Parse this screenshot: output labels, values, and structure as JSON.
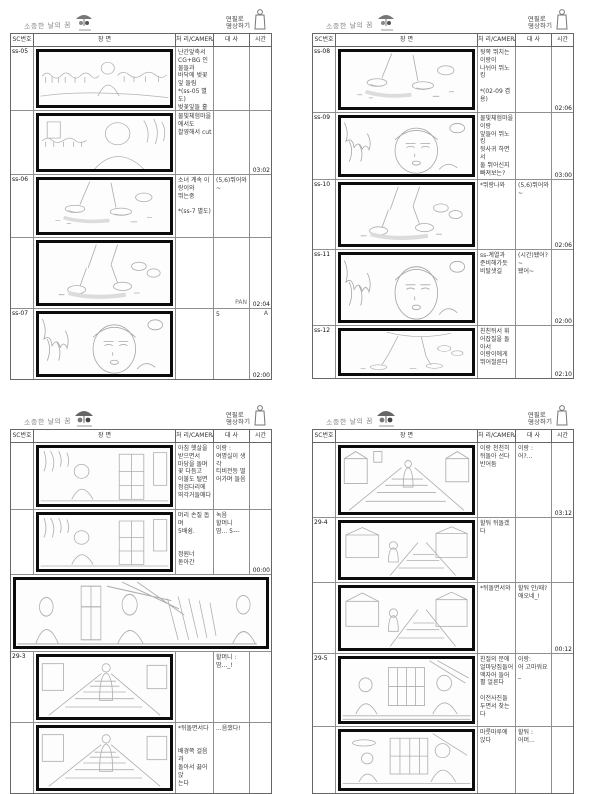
{
  "logo": {
    "left_title": "소중한 날의 꿈",
    "right_line1": "연필로",
    "right_line2": "명상하기"
  },
  "table_header": {
    "sc": "SC번호",
    "scene": "장  면",
    "camera": "처 리/CAMERA",
    "dialog": "대  사",
    "time": "시간"
  },
  "pages": [
    {
      "name": "page-1",
      "rows": [
        {
          "sc": "ss-05",
          "camera": "난간앞축서\nCG+BG 인물들과\n바닥에 벚꽃잎 들림\n*(ss-05 별도)\n벚꽃잎들 흩날려 쌓여있어 심게",
          "dialog": "",
          "time": "",
          "mark": ""
        },
        {
          "sc": "",
          "camera": "물빛체험마을에서도\n촬영해서 cut",
          "dialog": "",
          "time": "03:02",
          "mark": ""
        },
        {
          "sc": "ss-06",
          "camera": "소녀 계속 이랑이와\n뛰는중\n\n*(ss-7 별도)",
          "dialog": "(5,6)뛰어와~",
          "time": "",
          "mark": ""
        },
        {
          "sc": "",
          "camera": "",
          "dialog": "PAN",
          "time": "02:04",
          "mark": ""
        },
        {
          "sc": "ss-07",
          "camera": "",
          "dialog": "5",
          "time": "02:00",
          "mark": "A"
        }
      ]
    },
    {
      "name": "page-2",
      "rows": [
        {
          "sc": "ss-08",
          "camera": "뒷쪽 뛰치는 이랑이\n나뉘어 뛰노킹\n\n*(02-09 겸용)",
          "dialog": "",
          "time": "02:06",
          "mark": ""
        },
        {
          "sc": "ss-09",
          "camera": "물빛체험마을 이랑\n앞들어 뛰노킹\n뒷사귀 하면서\n둘 뛰어신지 빠져보는?\n\n*(ss-7A 겸용)",
          "dialog": "",
          "time": "03:00",
          "mark": ""
        },
        {
          "sc": "ss-10",
          "camera": "*뛰랑나와",
          "dialog": "(5,6)뛰어와~",
          "time": "02:06",
          "mark": ""
        },
        {
          "sc": "ss-11",
          "camera": "ss-계열과\n준비해가듯 비탈샛길",
          "dialog": "(시간)됐어?~\n됐어~",
          "time": "02:00",
          "mark": ""
        },
        {
          "sc": "ss-12",
          "camera": "친친뒤서 휘어잡질을 돌아서\n이랑이에게 뛰어절른다",
          "dialog": "",
          "time": "02:10",
          "mark": ""
        }
      ]
    },
    {
      "name": "page-3",
      "rows": [
        {
          "sc": "",
          "camera": "아침 햇살을\n받으면서\n마당을 돌며\n꽃 다듬고\n이불도 털면\n정검다리에\n뙤각거들매다",
          "dialog": "이랑 :\n여명실이 생각\n티비전등 떨어가며 들음",
          "time": "",
          "mark": ""
        },
        {
          "sc": "",
          "camera": "머리 손질 돕며\n5배쉼.\n\n\n정원너\n돋아간",
          "dialog": "녹음\n할머니\n땀... 5---",
          "time": "00:00",
          "mark": ""
        },
        {
          "wide": true
        },
        {
          "sc": "29-3",
          "camera": "",
          "dialog": "할머니 :\n땀..._!",
          "time": "",
          "mark": ""
        },
        {
          "sc": "",
          "camera": "*뒤돌면서다\n\n\n배경쪽 걸음과\n돌아서 끓어앉\n는다",
          "dialog": "...음쟀다!",
          "time": "",
          "mark": ""
        }
      ]
    },
    {
      "name": "page-4",
      "rows": [
        {
          "sc": "",
          "camera": "이랑 천천히\n뒤돌아 선다\n반어둠",
          "dialog": "이랑 :\n어?...",
          "time": "03:12",
          "mark": ""
        },
        {
          "sc": "29-4",
          "camera": "할둬 뒤돌겠다",
          "dialog": "",
          "time": "",
          "mark": ""
        },
        {
          "sc": "",
          "camera": "*뒤돌면서와",
          "dialog": "할둬 안/때?애오네_!",
          "time": "00:12",
          "mark": ""
        },
        {
          "sc": "29-5",
          "camera": "친절의 문에\n얼마당집들어\n액자어 들어\n펼 얼른다\n\n이전사진들\n두면서 찾는다",
          "dialog": "이랑:\n어 고마워요_",
          "time": "",
          "mark": ""
        },
        {
          "sc": "",
          "camera": "마룻마루에\n앉다",
          "dialog": "할둬 :\n어머...",
          "time": "",
          "mark": ""
        }
      ]
    }
  ]
}
